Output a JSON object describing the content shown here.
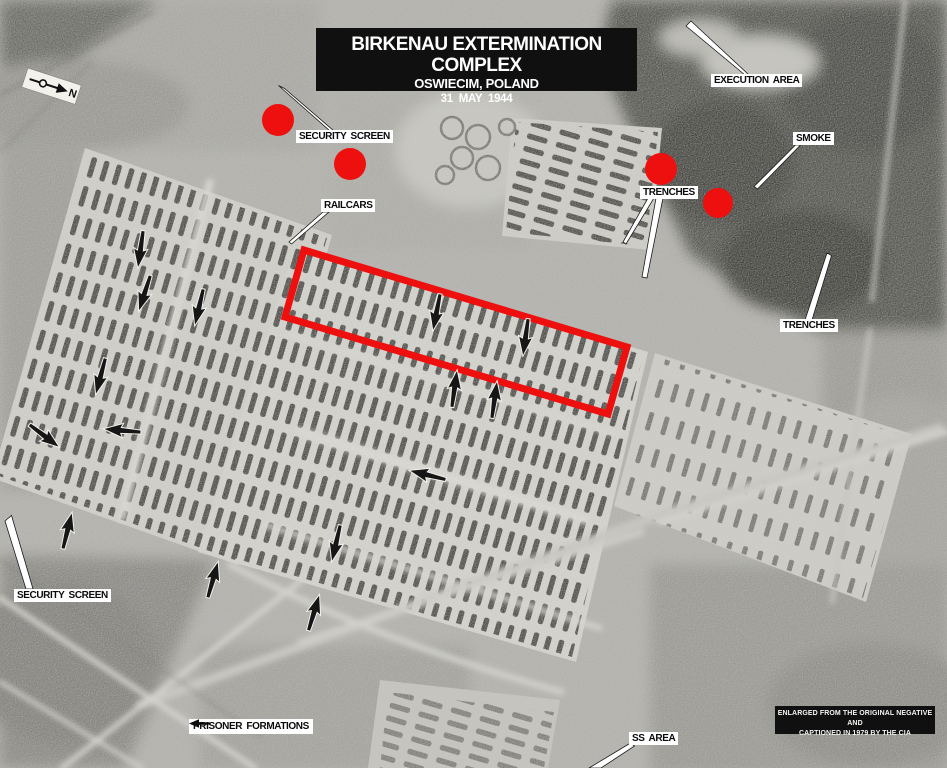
{
  "title_box": {
    "line1": "BIRKENAU EXTERMINATION COMPLEX",
    "line2": "OSWIECIM, POLAND",
    "line3": "31 MAY 1944"
  },
  "caption_box": {
    "line1": "ENLARGED FROM THE ORIGINAL NEGATIVE AND",
    "line2": "CAPTIONED IN 1979 BY THE CIA"
  },
  "compass": {
    "label": "N"
  },
  "labels": {
    "security_screen_top": "SECURITY SCREEN",
    "railcars": "RAILCARS",
    "execution_area": "EXECUTION AREA",
    "smoke": "SMOKE",
    "trenches_upper": "TRENCHES",
    "trenches_lower": "TRENCHES",
    "security_screen_bottom": "SECURITY SCREEN",
    "prisoner_formations": "PRISONER FORMATIONS",
    "ss_area": "SS AREA"
  },
  "colors": {
    "annotation_red": "#ee0f0f",
    "leader_white": "#ffffff",
    "arrow_black": "#161616",
    "label_bg": "#ffffff",
    "label_text": "#0b0b0b",
    "title_bg": "#101010",
    "title_text": "#ffffff"
  },
  "annotations": {
    "red_rectangle": {
      "points": "304,250 627,347 608,414 285,317",
      "stroke_width": 7
    },
    "red_dots": [
      {
        "x": 278,
        "y": 120,
        "r": 16
      },
      {
        "x": 350,
        "y": 164,
        "r": 16
      },
      {
        "x": 661,
        "y": 169,
        "r": 16
      },
      {
        "x": 718,
        "y": 203,
        "r": 15
      }
    ],
    "leaders": [
      {
        "name": "security-screen-top",
        "points": "278.5,85.5 284.5,88.5 334,131 330,131"
      },
      {
        "name": "execution-area",
        "points": "686,26 691,21 749,75 745,75"
      },
      {
        "name": "smoke",
        "points": "795.5,145 800.5,145 757.5,189 754,186.5"
      },
      {
        "name": "railcars",
        "points": "323,212 329,212 291.5,244 289,242"
      },
      {
        "name": "trenches-upper-a",
        "points": "648,198 654,198 626,244 623,242"
      },
      {
        "name": "trenches-upper-b",
        "points": "656,198 663,198 647,278 642,277"
      },
      {
        "name": "trenches-lower",
        "points": "827,253 831.5,255.5 812,320 805,320"
      },
      {
        "name": "security-screen-bottom",
        "points": "5,521 11.5,515.5 33,589 26,589"
      },
      {
        "name": "ss-area",
        "points": "630.5,743 634.5,746 601,768 589,768"
      }
    ],
    "arrows": [
      {
        "x": 140.5,
        "y": 249.5,
        "rot": 8
      },
      {
        "x": 144.5,
        "y": 293.5,
        "rot": 18
      },
      {
        "x": 199,
        "y": 307.5,
        "rot": 13
      },
      {
        "x": 100.5,
        "y": 376.5,
        "rot": 15
      },
      {
        "x": 44.5,
        "y": 436,
        "rot": -53
      },
      {
        "x": 122,
        "y": 430.5,
        "rot": 95
      },
      {
        "x": 427.5,
        "y": 475,
        "rot": 104
      },
      {
        "x": 336,
        "y": 543.5,
        "rot": 13
      },
      {
        "x": 213,
        "y": 579.5,
        "rot": 196
      },
      {
        "x": 314,
        "y": 612.5,
        "rot": 197
      },
      {
        "x": 67.5,
        "y": 530.5,
        "rot": 194
      },
      {
        "x": 436.5,
        "y": 312.5,
        "rot": 11
      },
      {
        "x": 525.5,
        "y": 337.5,
        "rot": 8
      },
      {
        "x": 454.5,
        "y": 388.5,
        "rot": 188
      },
      {
        "x": 494.5,
        "y": 399.5,
        "rot": 188
      }
    ]
  }
}
